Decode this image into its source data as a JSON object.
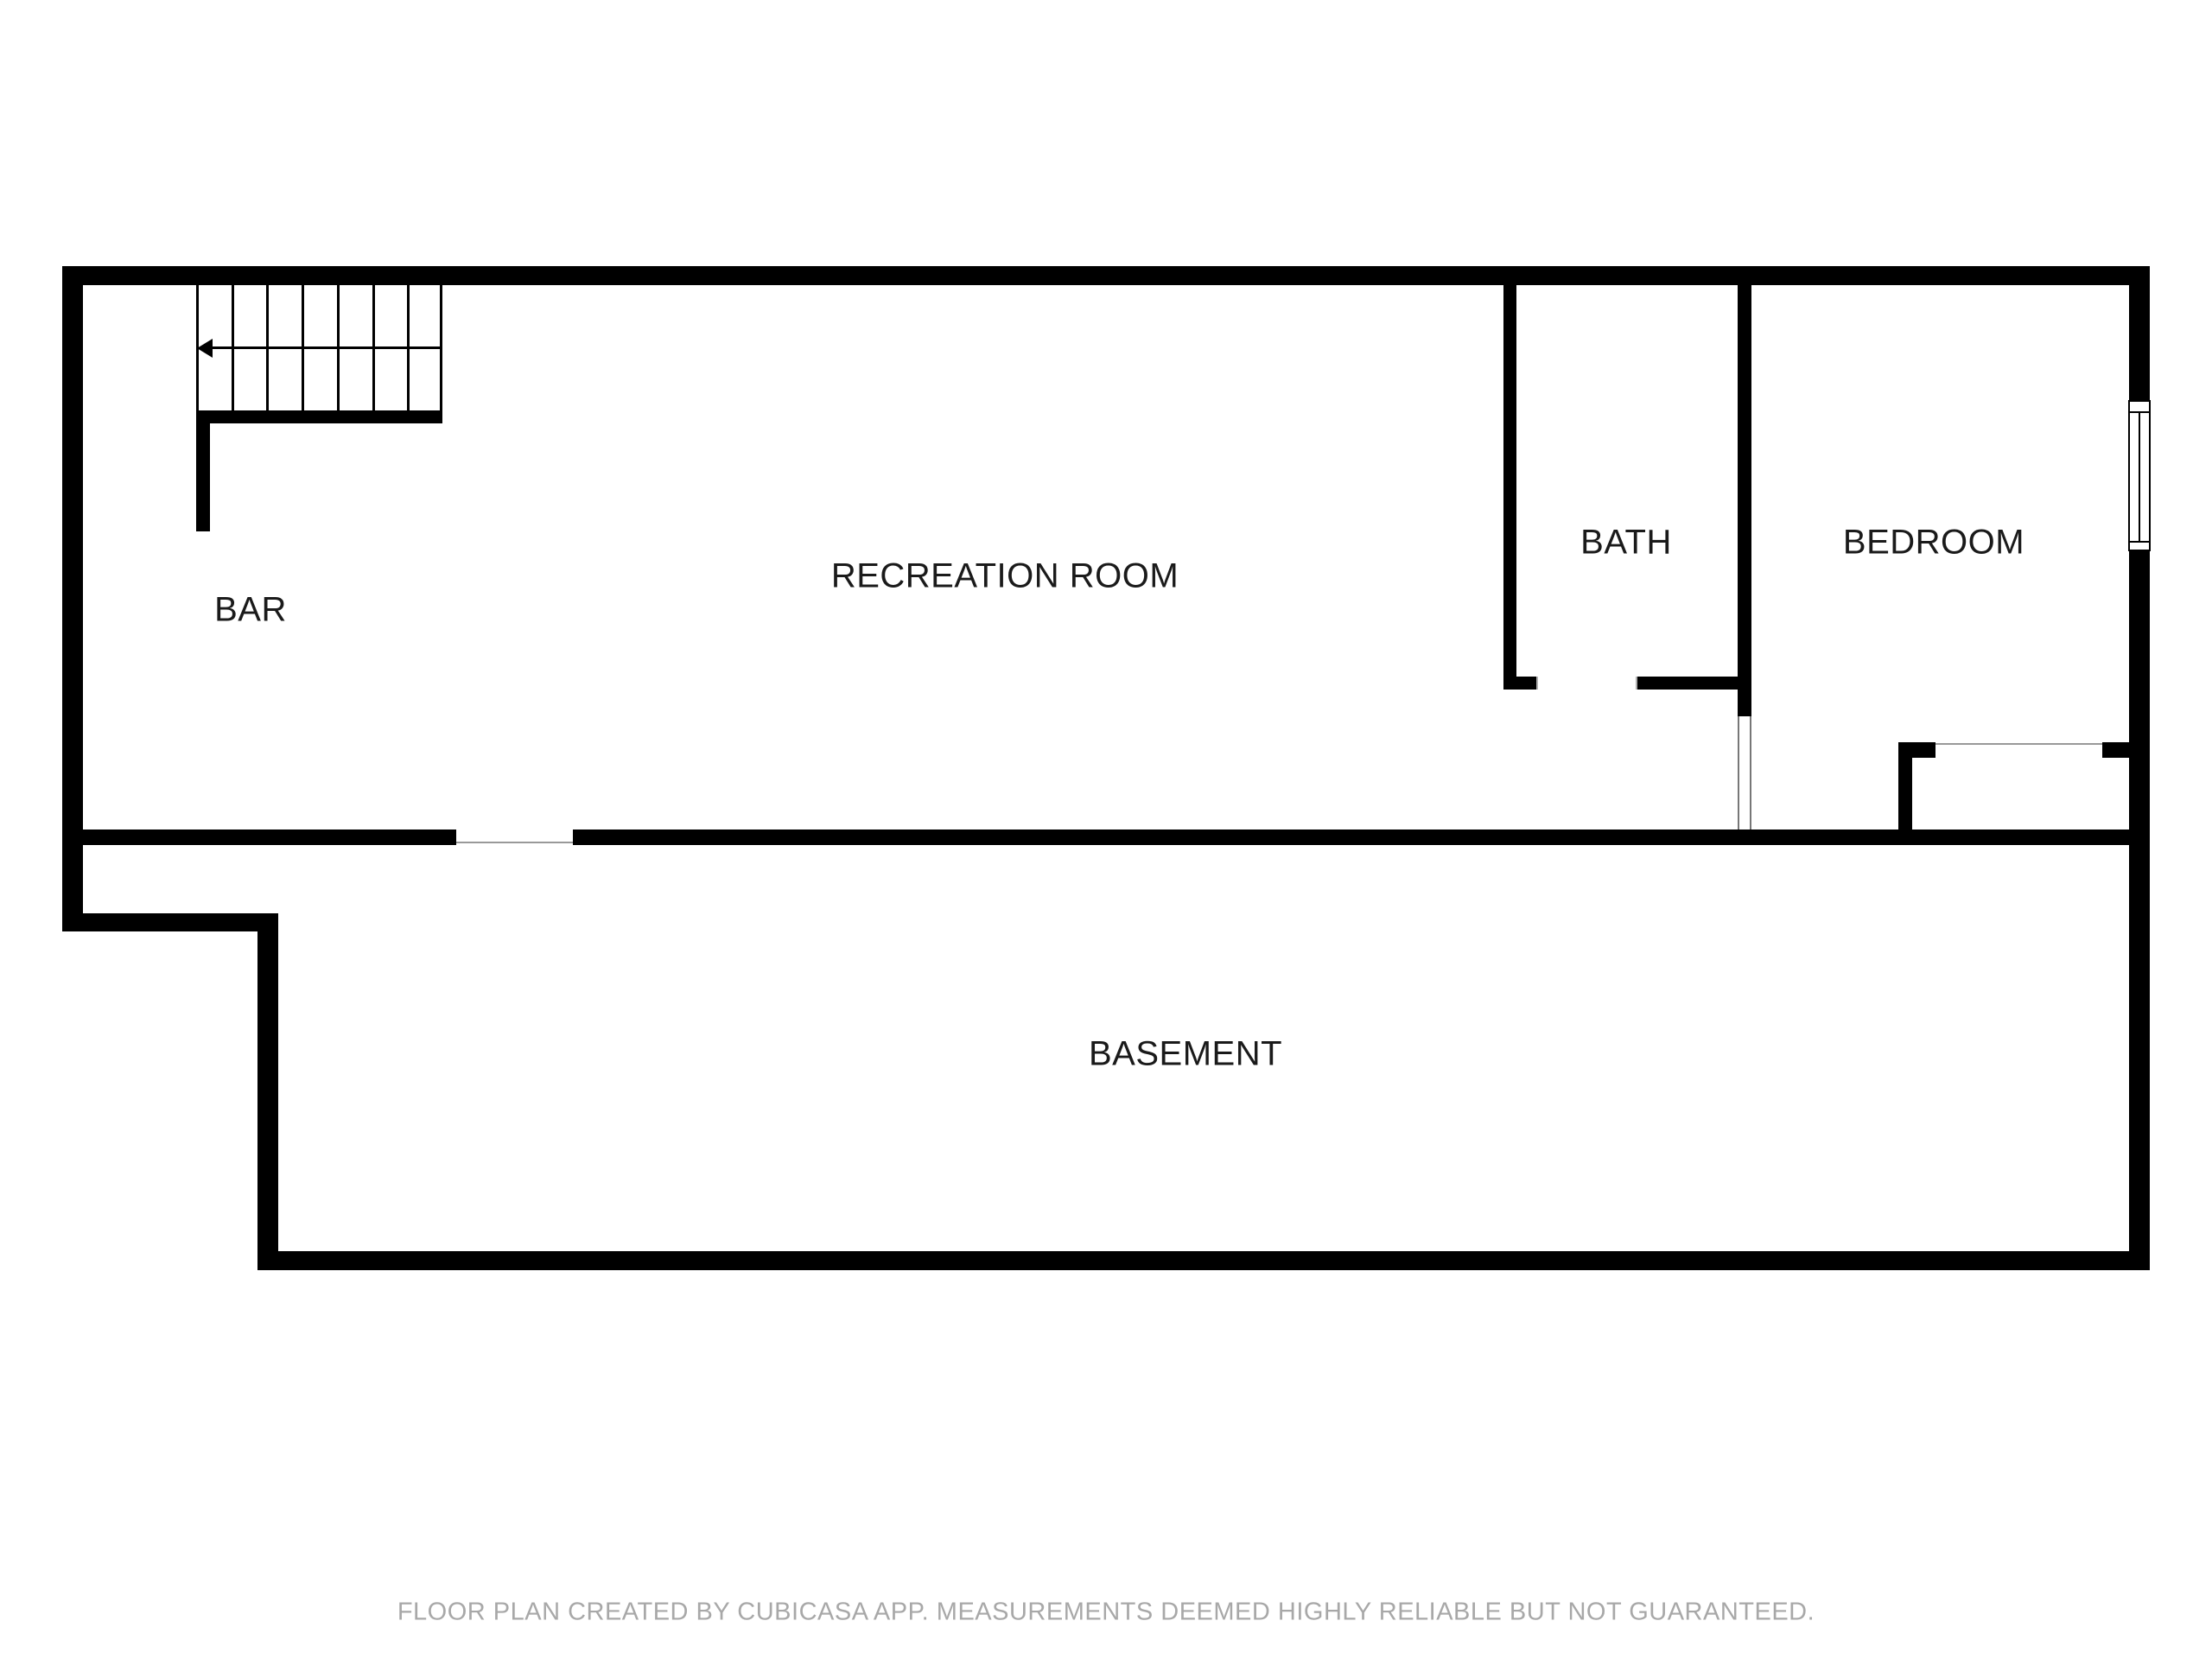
{
  "rooms": {
    "bar": "BAR",
    "recreation": "RECREATION ROOM",
    "bath": "BATH",
    "bedroom": "BEDROOM",
    "basement": "BASEMENT"
  },
  "footer": {
    "disclaimer": "FLOOR PLAN CREATED BY CUBICASA APP. MEASUREMENTS DEEMED HIGHLY RELIABLE BUT NOT GUARANTEED."
  },
  "colors": {
    "wall": "#000000",
    "thin_line": "#999999",
    "label_text": "#1a1a1a",
    "footer_text": "#a8a8a8"
  }
}
